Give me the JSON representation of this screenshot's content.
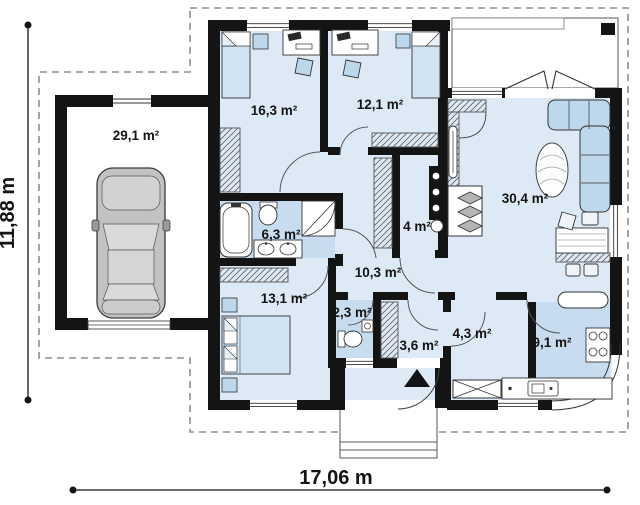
{
  "plan": {
    "dimension_height_label": "11,88 m",
    "dimension_width_label": "17,06 m",
    "rooms": {
      "garage": "29,1 m²",
      "bedroom1": "16,3 m²",
      "bedroom2": "12,1 m²",
      "living_room": "30,4 m²",
      "bathroom": "6,3 m²",
      "utility": "4 m²",
      "hallway": "10,3 m²",
      "bedroom3": "13,1 m²",
      "wc": "2,3 m²",
      "entry": "3,6 m²",
      "corridor": "4,3 m²",
      "kitchen": "9,1 m²"
    },
    "colors": {
      "wall": "#141414",
      "floor": "#dde9f5",
      "floor_wet": "#c8dcef",
      "furniture": "#bdd7ec",
      "furniture_light": "#cfe3f3",
      "outline": "#333333",
      "dashed": "#8d8d8d",
      "text": "#141414"
    }
  }
}
